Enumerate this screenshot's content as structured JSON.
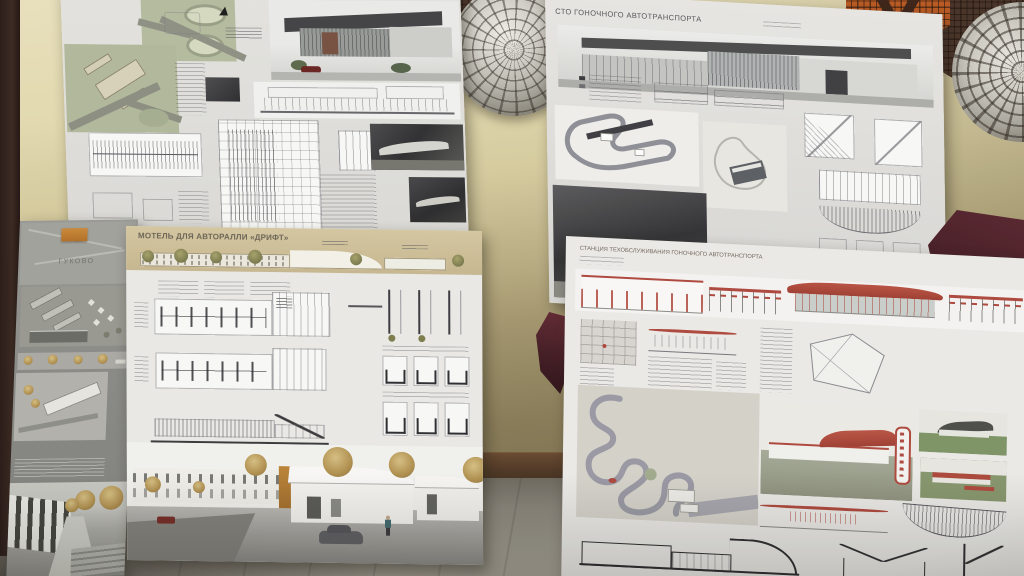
{
  "scene": {
    "description": "Photograph of four architectural student presentation boards leaning against a mosaic-decorated wall"
  },
  "boards": {
    "top_left": {
      "logo_glyph": "▲"
    },
    "top_right": {
      "title": "СТО ГОНОЧНОГО АВТОТРАНСПОРТА"
    },
    "dark_left": {
      "map_label": "ГУКОВО"
    },
    "motel": {
      "title": "МОТЕЛЬ ДЛЯ АВТОРАЛЛИ «ДРИФТ»"
    },
    "station": {
      "title": "СТАНЦИЯ ТЕХОБСЛУЖИВАНИЯ ГОНОЧНОГО АВТОТРАНСПОРТА"
    }
  },
  "colors": {
    "wall_top": "#ece3bc",
    "wall_bottom": "#7b6f4b",
    "floor": "#9d988c",
    "baseboard": "#523823",
    "board_white": "#ebeae6",
    "board_dark_gray": "#8f8f8b",
    "motel_header_beige": "#d2c297",
    "accent_red": "#b6473a",
    "accent_orange": "#bd7a2c",
    "mosaic_orange": "#c2591d",
    "mosaic_brown": "#4e342a",
    "mosaic_silver": "#d3d0c7",
    "autumn_tree": "#b5924c",
    "cloth_maroon": "#5e2630"
  }
}
